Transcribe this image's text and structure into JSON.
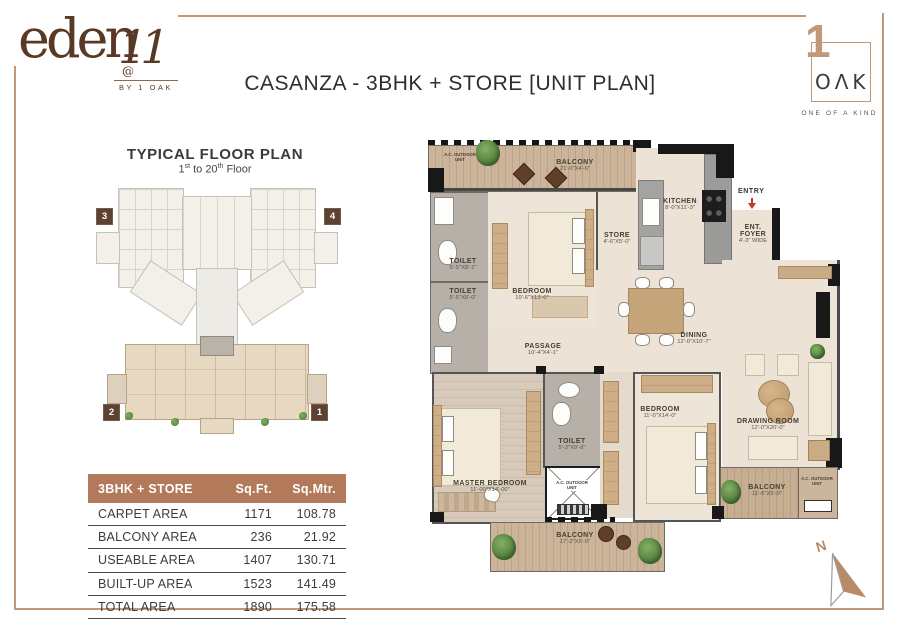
{
  "brand": {
    "eden_logo": {
      "name": "eden",
      "overlay": "11",
      "at": "@",
      "byline": "BY 1 OAK"
    },
    "oak_logo": {
      "one": "1",
      "oak": "OΛK",
      "tagline": "ONE OF A KIND"
    }
  },
  "title": "CASANZA - 3BHK + STORE [UNIT PLAN]",
  "typical_plan": {
    "heading": "TYPICAL FLOOR PLAN",
    "sub": {
      "p1": "1",
      "s1": "st",
      "p2": " to 20",
      "s2": "th",
      "p3": " Floor"
    },
    "markers": [
      "3",
      "4",
      "2",
      "1"
    ]
  },
  "area_table": {
    "columns": [
      "3BHK + STORE",
      "Sq.Ft.",
      "Sq.Mtr."
    ],
    "rows": [
      {
        "label": "CARPET AREA",
        "sqft": "1171",
        "sqmtr": "108.78"
      },
      {
        "label": "BALCONY AREA",
        "sqft": "236",
        "sqmtr": "21.92"
      },
      {
        "label": "USEABLE AREA",
        "sqft": "1407",
        "sqmtr": "130.71"
      },
      {
        "label": "BUILT-UP AREA",
        "sqft": "1523",
        "sqmtr": "141.49"
      },
      {
        "label": "TOTAL AREA",
        "sqft": "1890",
        "sqmtr": "175.58"
      }
    ]
  },
  "unit_plan": {
    "entry": "ENTRY",
    "compass": "N",
    "ac_unit": "A.C. OUTDOOR UNIT",
    "rooms": {
      "balcony_top": {
        "name": "BALCONY",
        "dims": "21'-0\"X4'-6\""
      },
      "toilet1": {
        "name": "TOILET",
        "dims": "5'-5\"X8'-1\""
      },
      "toilet2": {
        "name": "TOILET",
        "dims": "5'-5\"X8'-0\""
      },
      "bedroom1": {
        "name": "BEDROOM",
        "dims": "10'-6\"X13'-0\""
      },
      "store": {
        "name": "STORE",
        "dims": "4'-6\"X5'-0\""
      },
      "kitchen": {
        "name": "KITCHEN",
        "dims": "8'-0\"X11'-3\""
      },
      "foyer": {
        "name": "ENT. FOYER",
        "dims": "4'-3\" WIDE"
      },
      "passage": {
        "name": "PASSAGE",
        "dims": "10'-4\"X4'-1\""
      },
      "dining": {
        "name": "DINING",
        "dims": "12'-0\"X10'-7\""
      },
      "master": {
        "name": "MASTER BEDROOM",
        "dims": "11'-00\"X14'-00\""
      },
      "toilet3": {
        "name": "TOILET",
        "dims": "5'-3\"X9'-6\""
      },
      "bedroom2": {
        "name": "BEDROOM",
        "dims": "11'-0\"X14'-0\""
      },
      "drawing": {
        "name": "DRAWING ROOM",
        "dims": "12'-0\"X20'-0\""
      },
      "balcony_right": {
        "name": "BALCONY",
        "dims": "11'-6\"X5'-0\""
      },
      "balcony_bottom": {
        "name": "BALCONY",
        "dims": "17'-2\"X5'-0\""
      }
    }
  },
  "colors": {
    "accent": "#b3795b",
    "frame": "#c19878",
    "logo_brown": "#5a3826",
    "copper": "#b98a66"
  }
}
